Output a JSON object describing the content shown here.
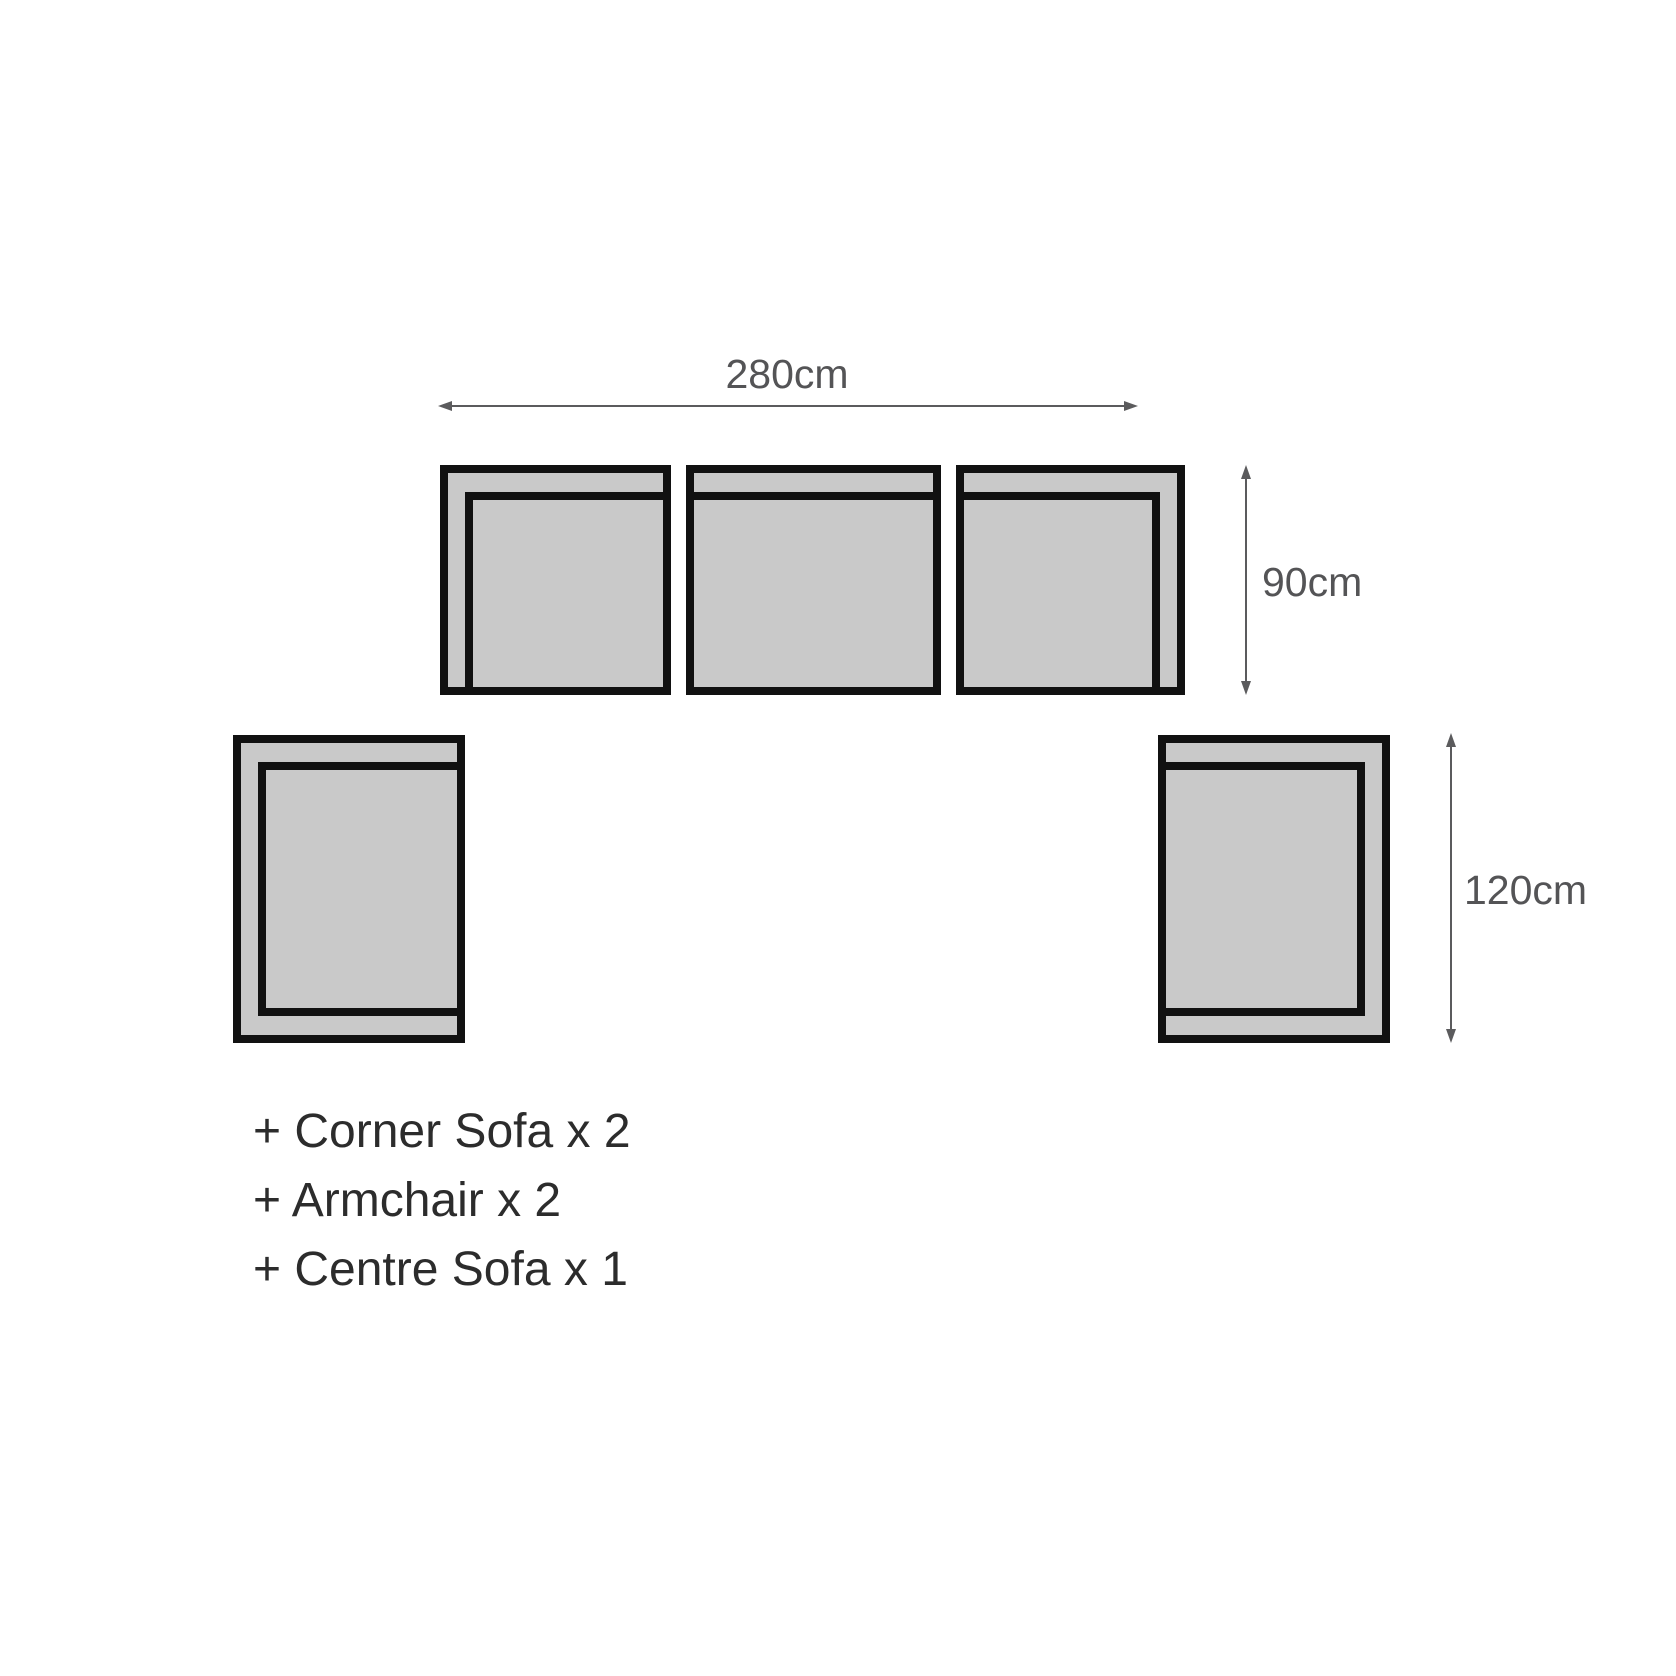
{
  "diagram_type": "sofa-set-dimensions",
  "dimensions": {
    "total_width": "280cm",
    "sofa_depth": "90cm",
    "armchair_depth": "120cm"
  },
  "legend": {
    "items": [
      "+ Corner Sofa x 2",
      "+ Armchair x 2",
      "+ Centre Sofa x 1"
    ]
  },
  "pieces": [
    {
      "name": "corner-sofa-left",
      "row": "top",
      "arm_side": "left"
    },
    {
      "name": "centre-sofa",
      "row": "top",
      "arm_side": "none"
    },
    {
      "name": "corner-sofa-right",
      "row": "top",
      "arm_side": "right"
    },
    {
      "name": "armchair-left",
      "row": "bottom",
      "arm_side": "left-top-bottom"
    },
    {
      "name": "armchair-right",
      "row": "bottom",
      "arm_side": "right-top-bottom"
    }
  ],
  "colors": {
    "background": "#ffffff",
    "piece_fill": "#c9c9c9",
    "piece_outline": "#111111",
    "dim_line": "#5b5b5d",
    "dim_text": "#545456",
    "legend_text": "#2c2c2c"
  }
}
